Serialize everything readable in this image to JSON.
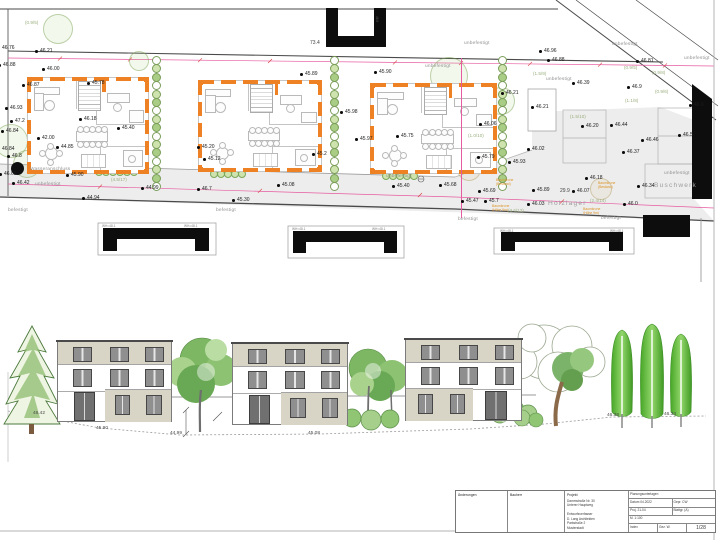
{
  "plan": {
    "points": [
      {
        "x": 40,
        "y": 51,
        "v": "46.21"
      },
      {
        "x": 2,
        "y": 48,
        "v": "46.76"
      },
      {
        "x": 3,
        "y": 65,
        "v": "46.88"
      },
      {
        "x": 47,
        "y": 69,
        "v": "46.00"
      },
      {
        "x": 27,
        "y": 85,
        "v": "46.87"
      },
      {
        "x": 92,
        "y": 83,
        "v": "45.78"
      },
      {
        "x": 10,
        "y": 108,
        "v": "46.93"
      },
      {
        "x": 15,
        "y": 121,
        "v": "47.2"
      },
      {
        "x": 6,
        "y": 131,
        "v": "46.84"
      },
      {
        "x": 2,
        "y": 149,
        "v": "46.84"
      },
      {
        "x": 12,
        "y": 156,
        "v": "46.8"
      },
      {
        "x": 84,
        "y": 119,
        "v": "46.18"
      },
      {
        "x": 122,
        "y": 128,
        "v": "45.40"
      },
      {
        "x": 42,
        "y": 138,
        "v": "42.00"
      },
      {
        "x": 61,
        "y": 147,
        "v": "44.85"
      },
      {
        "x": 17,
        "y": 183,
        "v": "46.42"
      },
      {
        "x": 71,
        "y": 175,
        "v": "45.90"
      },
      {
        "x": 4,
        "y": 174,
        "v": "46.68"
      },
      {
        "x": 305,
        "y": 74,
        "v": "45.89"
      },
      {
        "x": 345,
        "y": 112,
        "v": "45.98"
      },
      {
        "x": 202,
        "y": 147,
        "v": "45.20"
      },
      {
        "x": 208,
        "y": 159,
        "v": "45.12"
      },
      {
        "x": 317,
        "y": 154,
        "v": "45.2"
      },
      {
        "x": 282,
        "y": 185,
        "v": "45.08"
      },
      {
        "x": 146,
        "y": 188,
        "v": "44.99"
      },
      {
        "x": 202,
        "y": 189,
        "v": "46.7"
      },
      {
        "x": 87,
        "y": 198,
        "v": "44.94"
      },
      {
        "x": 237,
        "y": 200,
        "v": "45.30"
      },
      {
        "x": 379,
        "y": 72,
        "v": "45.90"
      },
      {
        "x": 506,
        "y": 93,
        "v": "46.21"
      },
      {
        "x": 536,
        "y": 107,
        "v": "46.21"
      },
      {
        "x": 360,
        "y": 139,
        "v": "45.97"
      },
      {
        "x": 401,
        "y": 136,
        "v": "45.75"
      },
      {
        "x": 484,
        "y": 124,
        "v": "46.06"
      },
      {
        "x": 482,
        "y": 157,
        "v": "45.79"
      },
      {
        "x": 513,
        "y": 162,
        "v": "45.93"
      },
      {
        "x": 444,
        "y": 185,
        "v": "45.68"
      },
      {
        "x": 397,
        "y": 186,
        "v": "45.40"
      },
      {
        "x": 544,
        "y": 51,
        "v": "46.96"
      },
      {
        "x": 552,
        "y": 60,
        "v": "46.88"
      },
      {
        "x": 641,
        "y": 61,
        "v": "46.81"
      },
      {
        "x": 577,
        "y": 83,
        "v": "46.39"
      },
      {
        "x": 632,
        "y": 87,
        "v": "46.9"
      },
      {
        "x": 694,
        "y": 105,
        "v": "46.6"
      },
      {
        "x": 586,
        "y": 126,
        "v": "46.20"
      },
      {
        "x": 615,
        "y": 125,
        "v": "46.44"
      },
      {
        "x": 646,
        "y": 140,
        "v": "46.46"
      },
      {
        "x": 683,
        "y": 135,
        "v": "46.5"
      },
      {
        "x": 627,
        "y": 152,
        "v": "46.37"
      },
      {
        "x": 532,
        "y": 149,
        "v": "46.02"
      },
      {
        "x": 590,
        "y": 178,
        "v": "46.18"
      },
      {
        "x": 642,
        "y": 186,
        "v": "46.34"
      },
      {
        "x": 537,
        "y": 190,
        "v": "45.89"
      },
      {
        "x": 577,
        "y": 191,
        "v": "46.07"
      },
      {
        "x": 532,
        "y": 204,
        "v": "46.03"
      },
      {
        "x": 628,
        "y": 204,
        "v": "46.0"
      },
      {
        "x": 466,
        "y": 201,
        "v": "45.47"
      },
      {
        "x": 489,
        "y": 201,
        "v": "45.7"
      },
      {
        "x": 483,
        "y": 191,
        "v": "45.69"
      }
    ],
    "surface_labels": [
      {
        "x": 35,
        "y": 185,
        "t": "unbefestigt"
      },
      {
        "x": 30,
        "y": 170,
        "t": "Wasseranschluss"
      },
      {
        "x": 386,
        "y": 177,
        "t": "unbefestigt"
      },
      {
        "x": 425,
        "y": 67,
        "t": "unbefestigt"
      },
      {
        "x": 546,
        "y": 80,
        "t": "unbefestigt"
      },
      {
        "x": 612,
        "y": 45,
        "t": "unbefestigt"
      },
      {
        "x": 684,
        "y": 59,
        "t": "unbefestigt"
      },
      {
        "x": 464,
        "y": 44,
        "t": "unbefestigt"
      },
      {
        "x": 664,
        "y": 174,
        "t": "unbefestigt"
      },
      {
        "x": 8,
        "y": 211,
        "t": "befestigt"
      },
      {
        "x": 216,
        "y": 211,
        "t": "befestigt"
      },
      {
        "x": 458,
        "y": 220,
        "t": "befestigt"
      },
      {
        "x": 601,
        "y": 219,
        "t": "befestigt"
      },
      {
        "x": 548,
        "y": 203,
        "t": "Holzlager",
        "big": true
      },
      {
        "x": 654,
        "y": 185,
        "t": "Buschwerk",
        "big": true
      }
    ],
    "tree_labels": [
      {
        "x": 25,
        "y": 23,
        "t": "(0.9/5)"
      },
      {
        "x": 533,
        "y": 74,
        "t": "(1.5/9)"
      },
      {
        "x": 624,
        "y": 68,
        "t": "(0.9/5)"
      },
      {
        "x": 652,
        "y": 73,
        "t": "(0.9/8)"
      },
      {
        "x": 655,
        "y": 92,
        "t": "(0.9/6)"
      },
      {
        "x": 625,
        "y": 101,
        "t": "(1.1/8)"
      },
      {
        "x": 570,
        "y": 117,
        "t": "(1.5/10)"
      },
      {
        "x": 468,
        "y": 136,
        "t": "(1.0/10)"
      },
      {
        "x": 111,
        "y": 180,
        "t": "(4.5/17)"
      },
      {
        "x": 508,
        "y": 211,
        "t": "(3.6/12)"
      },
      {
        "x": 590,
        "y": 201,
        "t": "(2.4/14)"
      }
    ],
    "orange_notes": [
      {
        "x": 496,
        "y": 180,
        "l1": "Baumkrone",
        "l2": "(Bestand)"
      },
      {
        "x": 598,
        "y": 183,
        "l1": "Baumkrone",
        "l2": "(Bestand)"
      },
      {
        "x": 492,
        "y": 206,
        "l1": "Baumkrone",
        "l2": "(Höhe 9m)"
      },
      {
        "x": 583,
        "y": 209,
        "l1": "Baumkrone",
        "l2": "(Höhe 9m)"
      }
    ],
    "dims": [
      {
        "x": 310,
        "y": 43,
        "t": "73.4"
      },
      {
        "x": 560,
        "y": 191,
        "t": "29.9"
      }
    ],
    "garage_label_text": "WH=48.1",
    "garage_label_pos": [
      {
        "x": 102,
        "y": 225
      },
      {
        "x": 184,
        "y": 225
      },
      {
        "x": 292,
        "y": 228
      },
      {
        "x": 372,
        "y": 228
      },
      {
        "x": 500,
        "y": 230
      },
      {
        "x": 610,
        "y": 230
      }
    ],
    "u_building_label": {
      "x": 378,
      "y": 16,
      "t": "46.8"
    }
  },
  "elevation": {
    "ground_labels": [
      {
        "x": 33,
        "y": 412,
        "v": "46.42"
      },
      {
        "x": 96,
        "y": 427,
        "v": "45.90"
      },
      {
        "x": 170,
        "y": 432,
        "v": "44.99"
      },
      {
        "x": 308,
        "y": 432,
        "v": "45.08"
      },
      {
        "x": 607,
        "y": 414,
        "v": "46.38"
      },
      {
        "x": 664,
        "y": 413,
        "v": "46.34"
      }
    ]
  },
  "title_block": {
    "changes_label": "Änderungen",
    "checked_label": "Bauherr",
    "project_label": "Projekt",
    "project_line1": "Dammstraße Nr. 30",
    "project_line2": "Unterer Hauptweg",
    "author_line1": "Entwurfsverfasser",
    "author_line2": "D. Lang Architekten",
    "author_line3": "Parkstraße 2",
    "author_line4": "Musterstadt",
    "office_header": "Planungsunterlagen",
    "row1a": "Datum 04.2022",
    "row1b": "Gepr. CW",
    "row2a": "Proj. 21-04",
    "row2b": "Blattgr. (A)",
    "row3a": "M. 1:100",
    "row3b": "",
    "c1": "Index",
    "c2": "Gez. W.",
    "sheet_no": "1/28"
  },
  "colors": {
    "wall_orange": "#ee8123",
    "dim_magenta": "#e75ba0",
    "hedge_green": "#86b05c",
    "facade_beige": "#d8d4c6",
    "window_gray": "#8f8f8f",
    "tree_green": "#4fae2f",
    "surface_gray": "#ededed"
  }
}
